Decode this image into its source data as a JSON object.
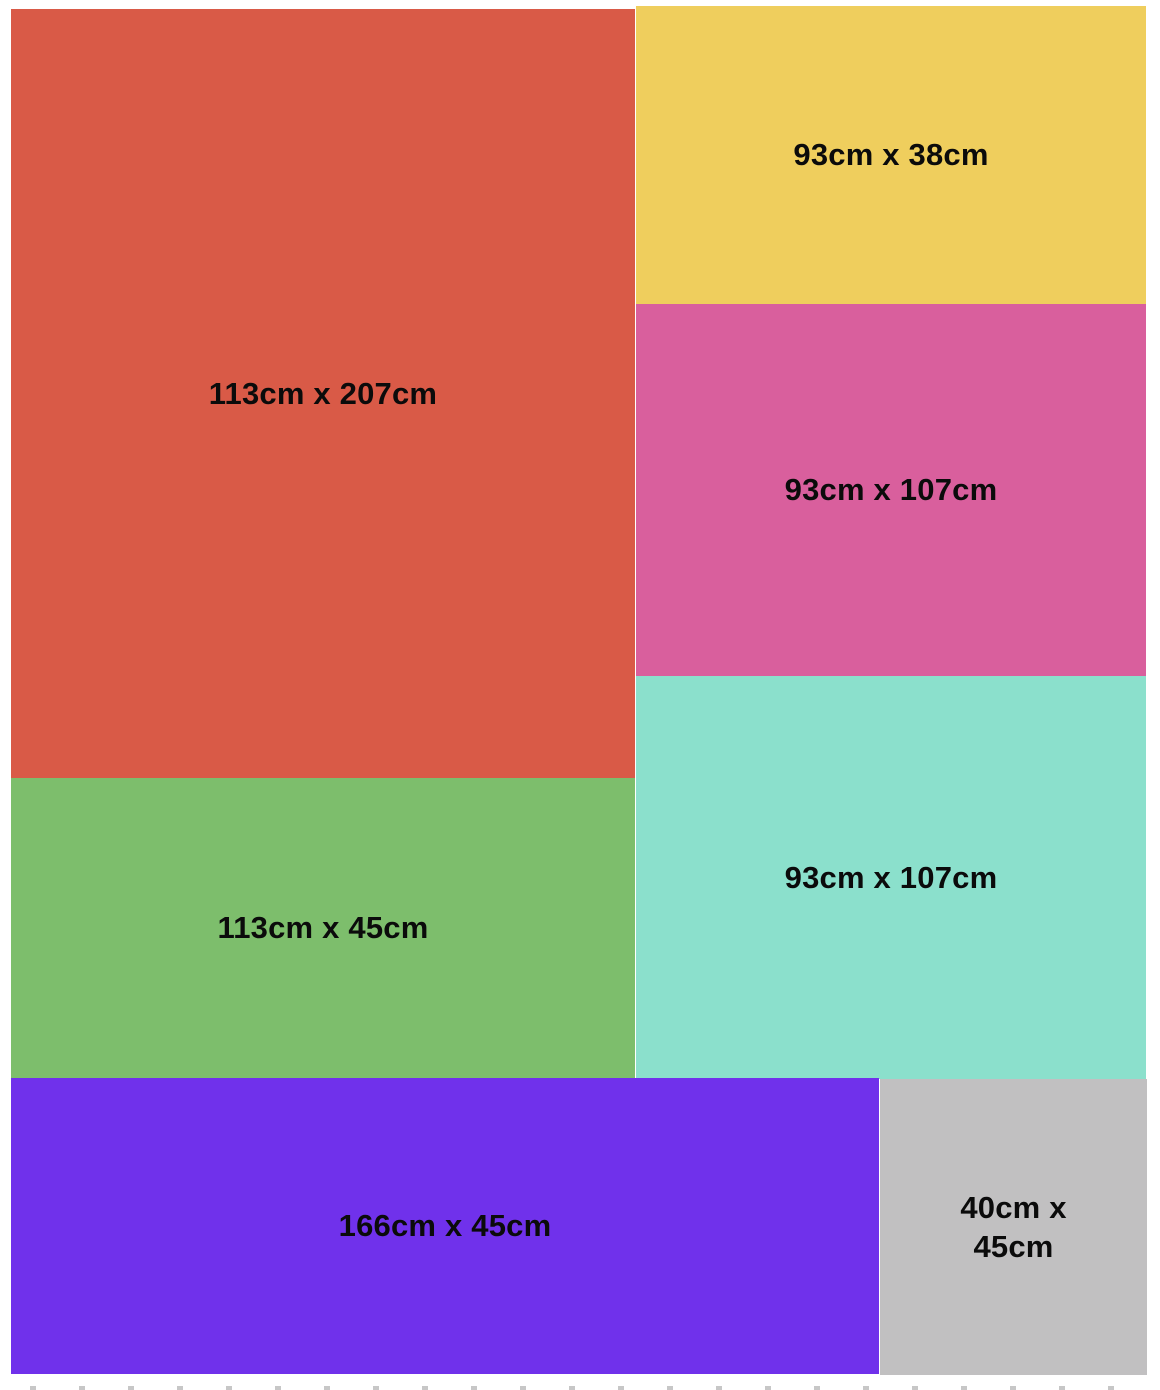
{
  "canvas": {
    "background": "#ffffff",
    "dashed_border_color": "#c7c7c7",
    "label_color": "#0b0b0b"
  },
  "pieces": [
    {
      "label": "113cm x 207cm",
      "width_cm": 113,
      "height_cm": 207,
      "color": "#d95a47",
      "rect": {
        "x": 11,
        "y": 9,
        "w": 624,
        "h": 769
      }
    },
    {
      "label": "93cm x 38cm",
      "width_cm": 93,
      "height_cm": 38,
      "color": "#efce5d",
      "rect": {
        "x": 636,
        "y": 6,
        "w": 510,
        "h": 298
      }
    },
    {
      "label": "93cm x 107cm",
      "width_cm": 93,
      "height_cm": 107,
      "color": "#d95f9d",
      "rect": {
        "x": 636,
        "y": 304,
        "w": 510,
        "h": 372
      }
    },
    {
      "label": "93cm x 107cm",
      "width_cm": 93,
      "height_cm": 107,
      "color": "#8be0cc",
      "rect": {
        "x": 636,
        "y": 676,
        "w": 510,
        "h": 403
      }
    },
    {
      "label": "113cm x 45cm",
      "width_cm": 113,
      "height_cm": 45,
      "color": "#7dbe6c",
      "rect": {
        "x": 11,
        "y": 778,
        "w": 624,
        "h": 300
      }
    },
    {
      "label": "166cm x 45cm",
      "width_cm": 166,
      "height_cm": 45,
      "color": "#7031eb",
      "rect": {
        "x": 11,
        "y": 1078,
        "w": 868,
        "h": 296
      }
    },
    {
      "label": "40cm x 45cm",
      "width_cm": 40,
      "height_cm": 45,
      "color": "#c1c0c1",
      "rect": {
        "x": 880,
        "y": 1079,
        "w": 267,
        "h": 296
      }
    }
  ]
}
